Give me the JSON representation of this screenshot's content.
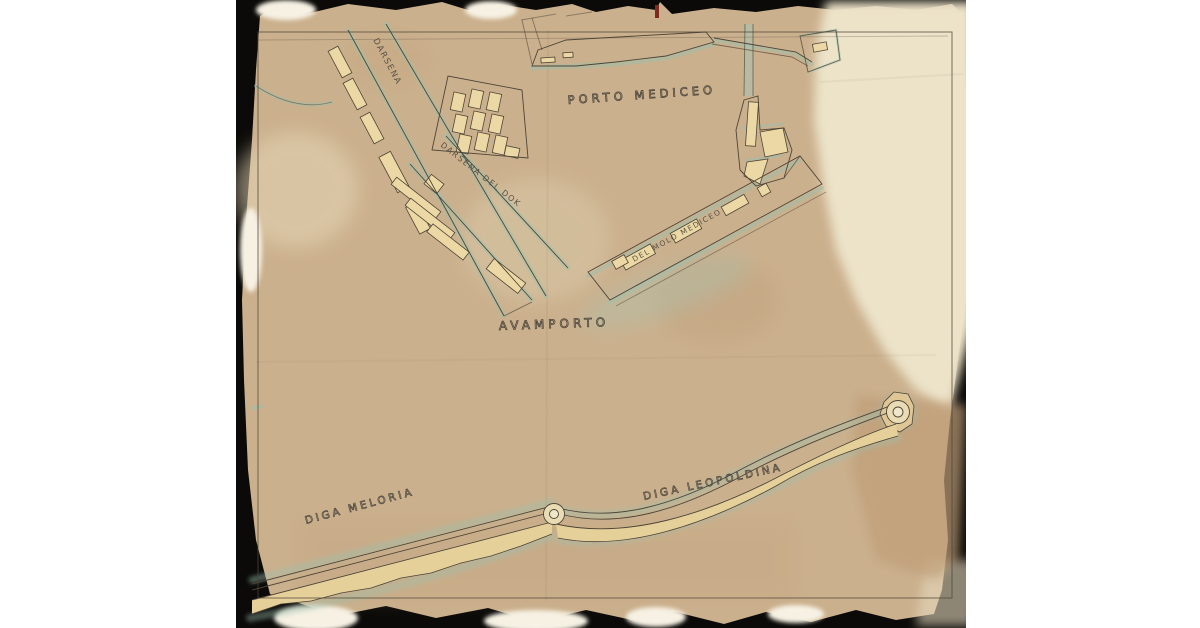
{
  "scan": {
    "description": "aged archival harbor plan on black scanner background",
    "labels": {
      "harbor": "PORTO MEDICEO",
      "outer_harbor": "AVAMPORTO",
      "dock_canal": "DARSENA",
      "dock_basin": "DARSENA DEL DOK",
      "pier": "DEL MOLO MEDICEO",
      "breakwater_west": "DIGA MELORIA",
      "breakwater_east": "DIGA LEOPOLDINA"
    },
    "colors": {
      "page_background": "#ffffff",
      "scan_background": "#0b0a08",
      "paper_light": "#ece3c9",
      "paper_stain": "#cbb08d",
      "paper_stain_dark": "#bf9e78",
      "torn_patch": "#f6f1e3",
      "building_fill": "#ecd8a4",
      "water_teal": "#9cc0ae",
      "ink": "#4e4537",
      "red_mark": "#7e2a1e"
    }
  }
}
